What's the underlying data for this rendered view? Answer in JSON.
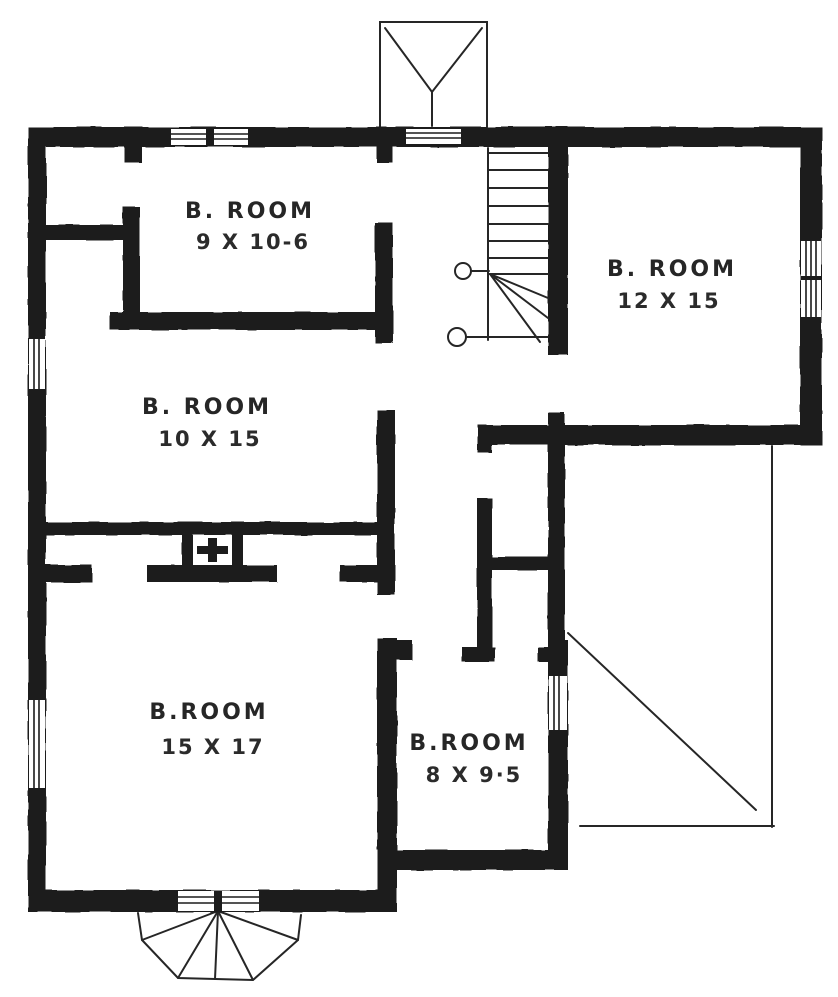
{
  "drawing": {
    "type": "floor-plan",
    "ink_color": "#1c1c1c",
    "paper_color": "#ffffff",
    "rooms": [
      {
        "label": "B. ROOM",
        "size": "9 X 10-6"
      },
      {
        "label": "B. ROOM",
        "size": "10 X 15"
      },
      {
        "label": "B. ROOM",
        "size": "12 X 15"
      },
      {
        "label": "B.ROOM",
        "size": "15 X 17"
      },
      {
        "label": "B.ROOM",
        "size": "8 X 9·5"
      }
    ],
    "features": [
      "staircase-with-winders",
      "chimney-flue",
      "bay-window-top",
      "bay-window-bottom",
      "porch-roof-outline",
      "double-hung-windows"
    ]
  }
}
